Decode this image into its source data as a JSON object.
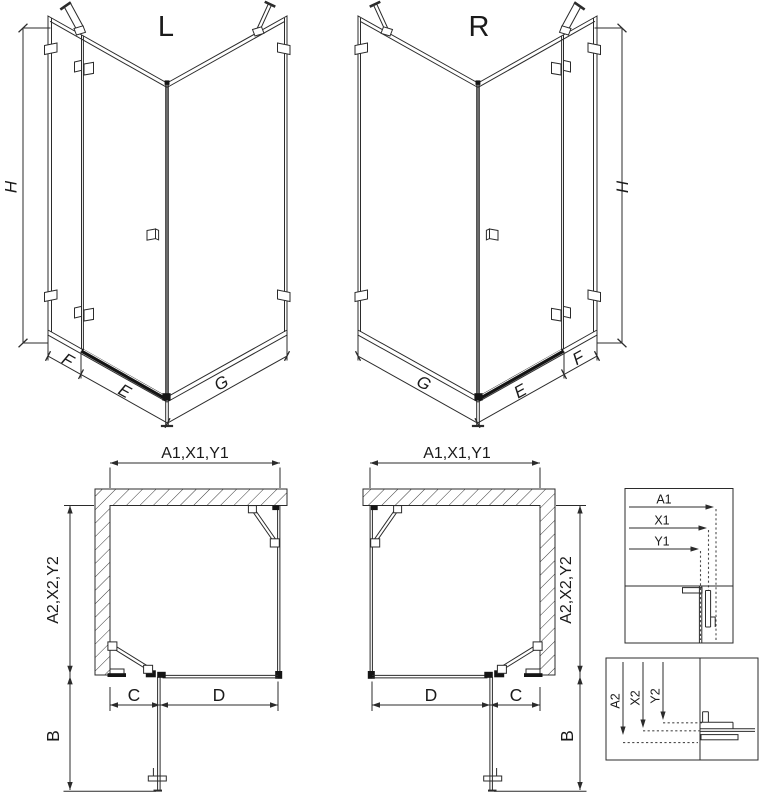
{
  "colors": {
    "background": "#ffffff",
    "line": "#2b2b2b",
    "dark_fill": "#141414",
    "hatch_line": "#3a3a3a"
  },
  "iso_left": {
    "title": "L",
    "dim_height": "H",
    "dim_fixed_panel": "F",
    "dim_door": "E",
    "dim_side_panel": "G"
  },
  "iso_right": {
    "title": "R",
    "dim_height": "H",
    "dim_fixed_panel": "F",
    "dim_door": "E",
    "dim_side_panel": "G"
  },
  "plan_left": {
    "dim_top": "A1,X1,Y1",
    "dim_side": "A2,X2,Y2",
    "dim_door_swing": "B",
    "dim_opening": "C",
    "dim_fixed": "D"
  },
  "plan_right": {
    "dim_top": "A1,X1,Y1",
    "dim_side": "A2,X2,Y2",
    "dim_door_swing": "B",
    "dim_opening": "C",
    "dim_fixed": "D"
  },
  "detail_width_section": {
    "labels": [
      "A1",
      "X1",
      "Y1"
    ]
  },
  "detail_depth_section": {
    "labels": [
      "A2",
      "X2",
      "Y2"
    ]
  }
}
